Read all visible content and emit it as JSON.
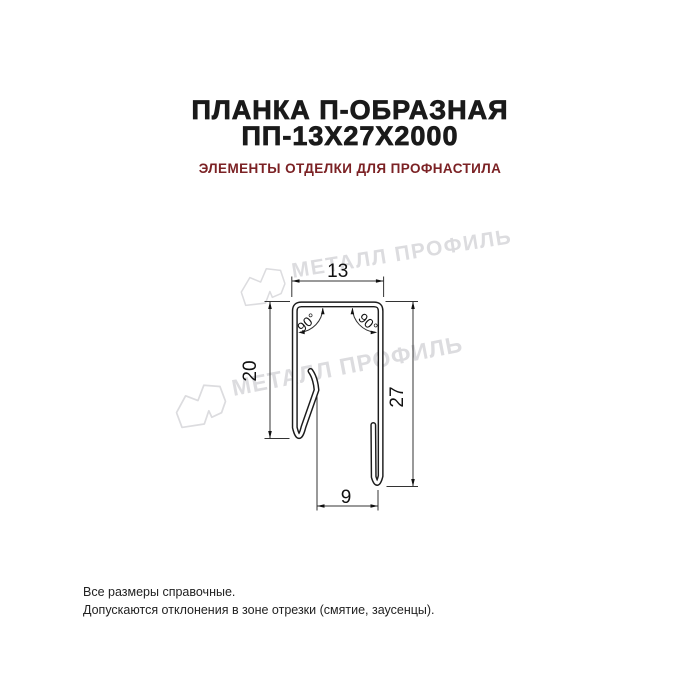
{
  "header": {
    "title_line1": "ПЛАНКА П-ОБРАЗНАЯ",
    "title_line2": "ПП-13Х27Х2000",
    "subtitle": "ЭЛЕМЕНТЫ ОТДЕЛКИ ДЛЯ ПРОФНАСТИЛА",
    "title_color": "#1a1a1a",
    "subtitle_color": "#7b2124"
  },
  "drawing": {
    "type": "technical-cross-section",
    "description": "U-shaped metal strip profile cross-section with dimension lines",
    "line_color": "#1c1c1c",
    "dimensions": {
      "top_width": "13",
      "left_height": "20",
      "right_height": "27",
      "bottom_width": "9",
      "angle_left": "90°",
      "angle_right": "90°"
    }
  },
  "watermark": {
    "text": "МЕТАЛЛ ПРОФИЛЬ",
    "color": "#dcdcdf",
    "logo": "cloud-mountain-logo"
  },
  "footer": {
    "line1": "Все размеры справочные.",
    "line2": "Допускаются отклонения в зоне отрезки (смятие, заусенцы)."
  }
}
